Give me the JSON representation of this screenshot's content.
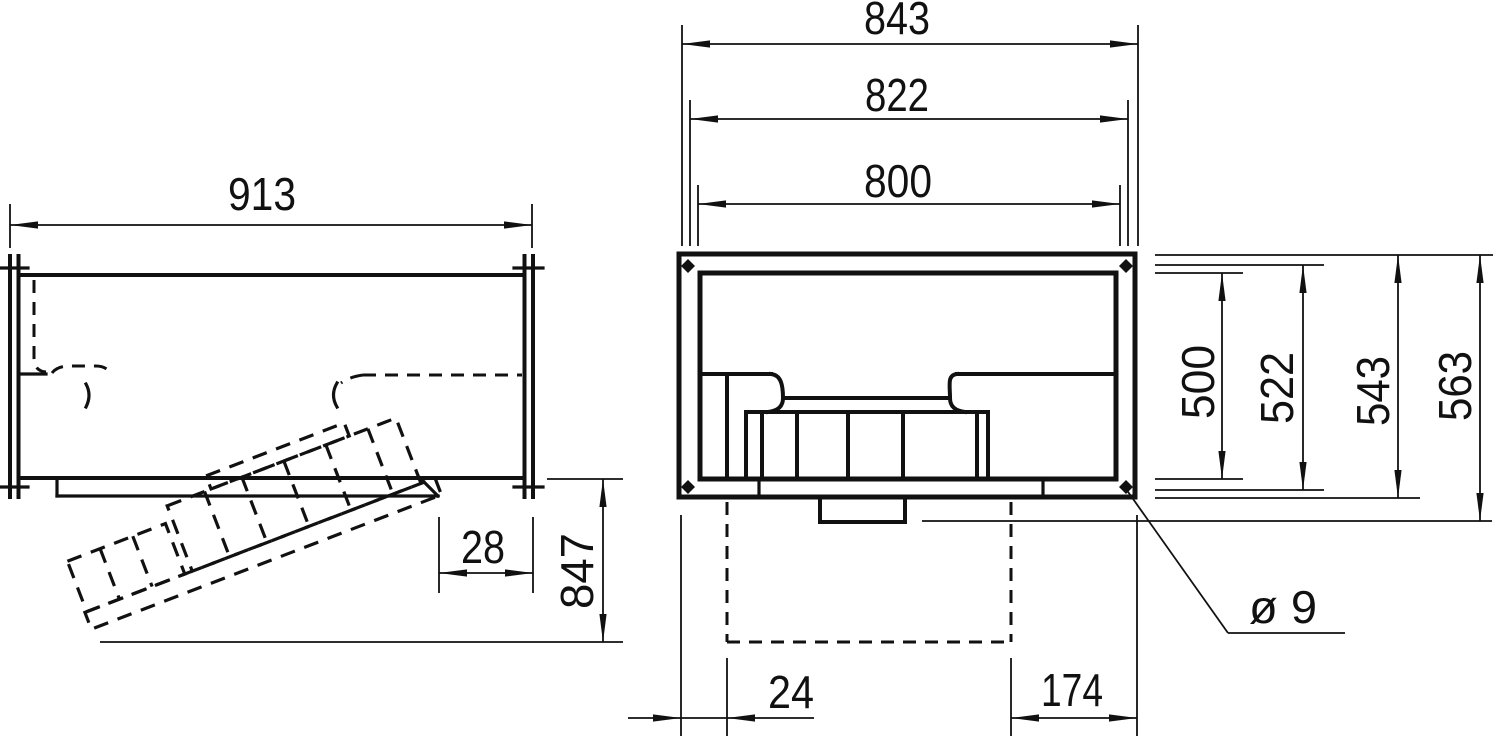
{
  "drawing": {
    "background": "#ffffff",
    "line_color": "#111111",
    "views": {
      "side": {
        "title": "side-view",
        "dims": {
          "overall_width": "913",
          "flange_depth": "28",
          "service_clearance": "847"
        }
      },
      "front": {
        "title": "front-view",
        "dims": {
          "flange_width": "843",
          "bolt_pitch_width": "822",
          "duct_width": "800",
          "duct_height": "500",
          "bolt_pitch_height": "522",
          "flange_height": "543",
          "overall_height": "563",
          "bottom_offset_left": "24",
          "bottom_offset_right": "174",
          "hole_diameter": "ø 9"
        }
      }
    }
  }
}
